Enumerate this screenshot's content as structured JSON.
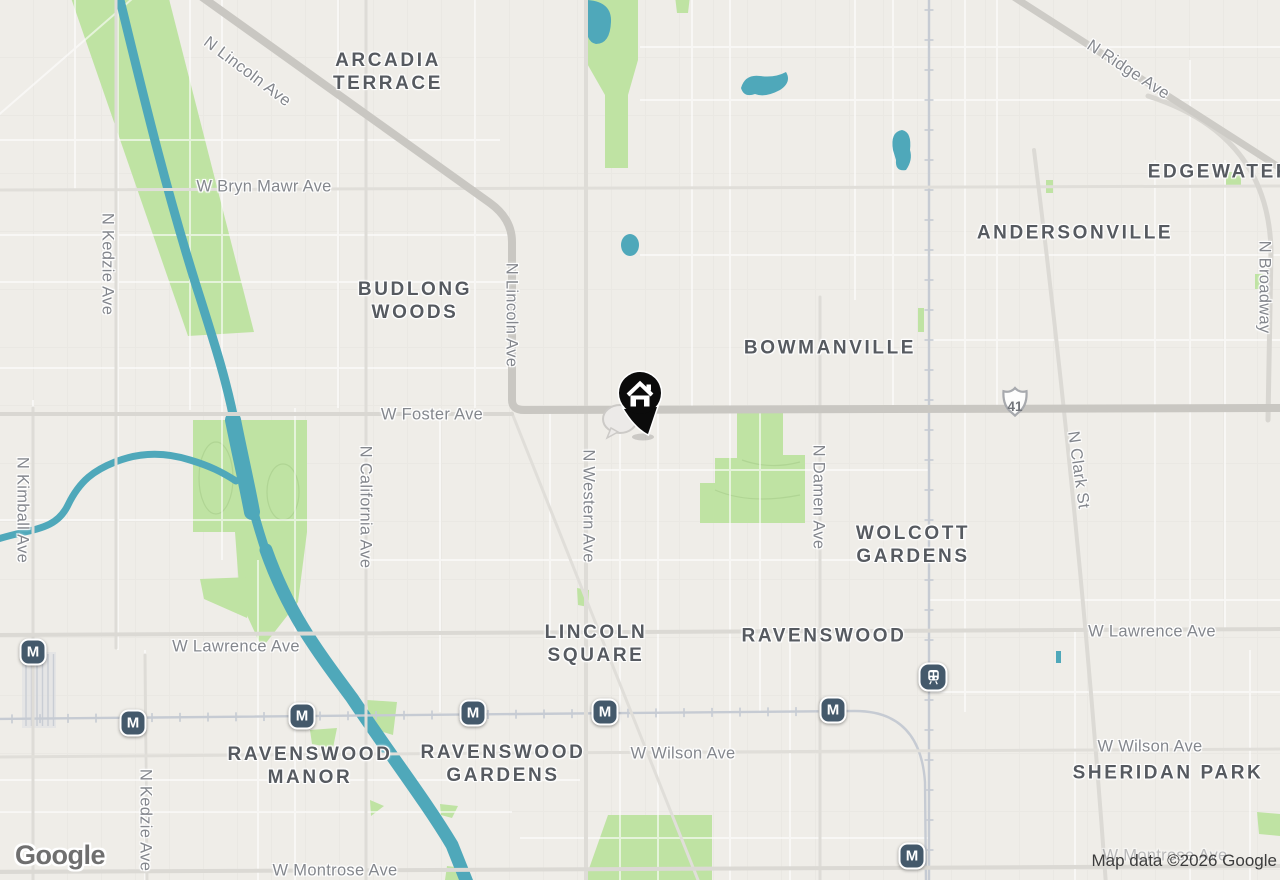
{
  "map": {
    "watermark": "Google",
    "attribution": "Map data ©2026 Google",
    "route_shield": {
      "type": "us-route-shield",
      "label": "41"
    },
    "colors": {
      "background": "#EFEDE8",
      "water": "#4FA8BA",
      "park": "#BFE3A3",
      "major_road": "#C9C7C2",
      "rail": "#C6CBD3",
      "transit_icon_bg": "#44596B",
      "neighborhood_label": "#565A60",
      "road_label": "#84878D",
      "home_pin": "#0B0B0B"
    },
    "neighborhoods": [
      {
        "name": "Arcadia Terrace",
        "lines": [
          "ARCADIA",
          "TERRACE"
        ],
        "x": 388,
        "y": 72
      },
      {
        "name": "Budlong Woods",
        "lines": [
          "BUDLONG",
          "WOODS"
        ],
        "x": 415,
        "y": 301
      },
      {
        "name": "Bowmanville",
        "lines": [
          "BOWMANVILLE"
        ],
        "x": 830,
        "y": 348
      },
      {
        "name": "Andersonville",
        "lines": [
          "ANDERSONVILLE"
        ],
        "x": 1075,
        "y": 233
      },
      {
        "name": "Edgewater",
        "lines": [
          "EDGEWATER"
        ],
        "x": 1220,
        "y": 172
      },
      {
        "name": "Wolcott Gardens",
        "lines": [
          "WOLCOTT",
          "GARDENS"
        ],
        "x": 913,
        "y": 545
      },
      {
        "name": "Lincoln Square",
        "lines": [
          "LINCOLN",
          "SQUARE"
        ],
        "x": 596,
        "y": 644
      },
      {
        "name": "Ravenswood",
        "lines": [
          "RAVENSWOOD"
        ],
        "x": 824,
        "y": 636
      },
      {
        "name": "Ravenswood Manor",
        "lines": [
          "RAVENSWOOD",
          "MANOR"
        ],
        "x": 310,
        "y": 766
      },
      {
        "name": "Ravenswood Gardens",
        "lines": [
          "RAVENSWOOD",
          "GARDENS"
        ],
        "x": 503,
        "y": 764
      },
      {
        "name": "Sheridan Park",
        "lines": [
          "SHERIDAN PARK"
        ],
        "x": 1168,
        "y": 773
      }
    ],
    "road_labels": [
      {
        "text": "N Lincoln Ave",
        "x": 247,
        "y": 72,
        "rot": 37
      },
      {
        "text": "W Bryn Mawr Ave",
        "x": 264,
        "y": 187,
        "rot": 0
      },
      {
        "text": "N Kedzie Ave",
        "x": 107,
        "y": 264,
        "rot": 90
      },
      {
        "text": "N Lincoln Ave",
        "x": 511,
        "y": 315,
        "rot": 90
      },
      {
        "text": "N Kimball Ave",
        "x": 22,
        "y": 510,
        "rot": 90
      },
      {
        "text": "N California Ave",
        "x": 365,
        "y": 507,
        "rot": 90
      },
      {
        "text": "W Foster Ave",
        "x": 432,
        "y": 415,
        "rot": 0
      },
      {
        "text": "N Western Ave",
        "x": 588,
        "y": 506,
        "rot": 90
      },
      {
        "text": "N Damen Ave",
        "x": 818,
        "y": 497,
        "rot": 90
      },
      {
        "text": "N Clark St",
        "x": 1078,
        "y": 470,
        "rot": 82
      },
      {
        "text": "N Broadway",
        "x": 1264,
        "y": 287,
        "rot": 90
      },
      {
        "text": "N Ridge Ave",
        "x": 1128,
        "y": 70,
        "rot": 33
      },
      {
        "text": "W Lawrence Ave",
        "x": 236,
        "y": 647,
        "rot": 0
      },
      {
        "text": "W Lawrence Ave",
        "x": 1152,
        "y": 632,
        "rot": 0
      },
      {
        "text": "W Wilson Ave",
        "x": 683,
        "y": 754,
        "rot": 0
      },
      {
        "text": "W Wilson Ave",
        "x": 1150,
        "y": 747,
        "rot": 0
      },
      {
        "text": "W Montrose Ave",
        "x": 335,
        "y": 871,
        "rot": 0
      },
      {
        "text": "W Montrose Ave",
        "x": 1165,
        "y": 856,
        "rot": 0,
        "faint": true
      },
      {
        "text": "N Kedzie Ave",
        "x": 145,
        "y": 820,
        "rot": 90
      }
    ],
    "stations": [
      {
        "type": "metro",
        "label": "M",
        "x": 33,
        "y": 652
      },
      {
        "type": "metro",
        "label": "M",
        "x": 133,
        "y": 723
      },
      {
        "type": "metro",
        "label": "M",
        "x": 302,
        "y": 716
      },
      {
        "type": "metro",
        "label": "M",
        "x": 473,
        "y": 713
      },
      {
        "type": "metro",
        "label": "M",
        "x": 605,
        "y": 712
      },
      {
        "type": "metro",
        "label": "M",
        "x": 833,
        "y": 710
      },
      {
        "type": "metro",
        "label": "M",
        "x": 912,
        "y": 856
      },
      {
        "type": "train",
        "label": "",
        "x": 933,
        "y": 677
      }
    ],
    "home_marker": {
      "type": "home-pin",
      "x": 640,
      "y": 394
    }
  }
}
